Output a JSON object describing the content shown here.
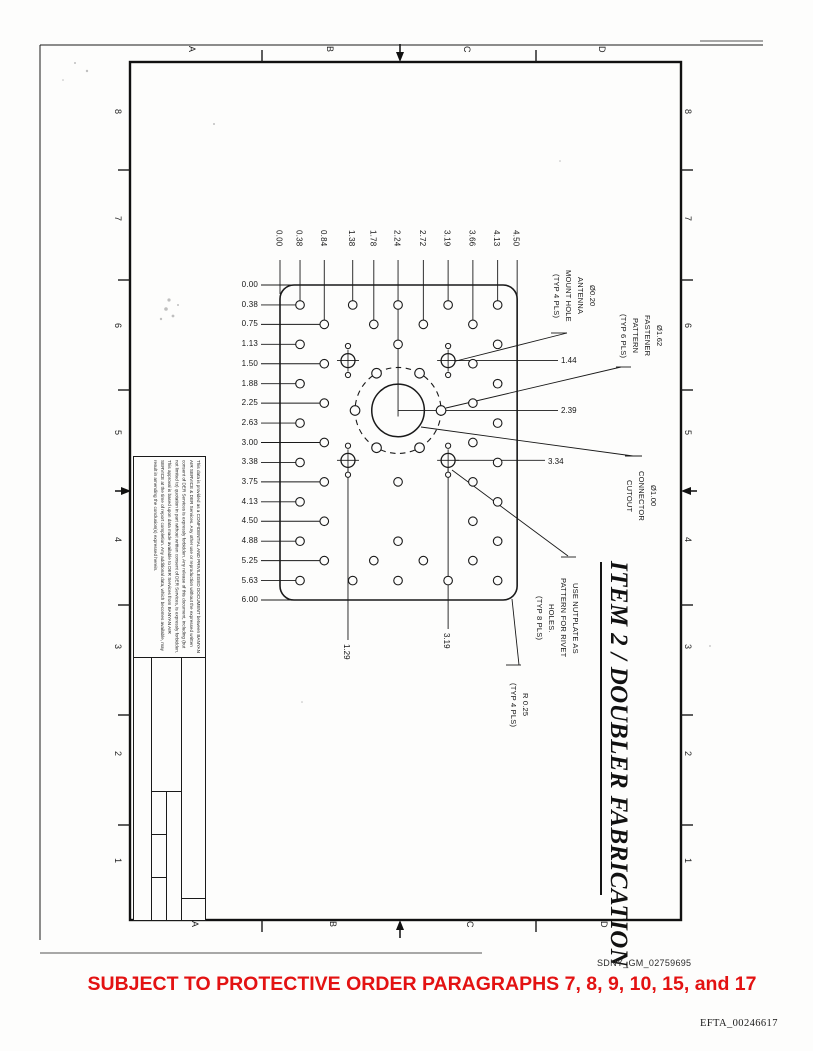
{
  "page": {
    "protective_order_text": "SUBJECT TO PROTECTIVE ORDER PARAGRAPHS 7, 8, 9, 10, 15, and 17",
    "bates_top": "SDNY_GM_02759695",
    "bates_bottom": "EFTA_00246617",
    "red_color": "#e31212"
  },
  "zones": {
    "letters": [
      "A",
      "B",
      "C",
      "D"
    ],
    "numbers": [
      "8",
      "7",
      "6",
      "5",
      "4",
      "3",
      "2",
      "1"
    ]
  },
  "drawing": {
    "item_title": "ITEM 2 / DOUBLER FABRICATION",
    "col_ordinates": [
      "0.00",
      "0.38",
      "0.84",
      "1.38",
      "1.78",
      "2.24",
      "2.72",
      "3.19",
      "3.66",
      "4.13",
      "4.50"
    ],
    "row_ordinates": [
      "0.00",
      "0.38",
      "0.75",
      "1.13",
      "1.50",
      "1.88",
      "2.25",
      "2.63",
      "3.00",
      "3.38",
      "3.75",
      "4.13",
      "4.50",
      "4.88",
      "5.25",
      "5.63",
      "6.00"
    ],
    "rivet_rows": [
      {
        "y": 0.38,
        "cols": [
          0.38,
          1.38,
          2.24,
          3.19,
          4.13
        ]
      },
      {
        "y": 0.75,
        "cols": [
          0.84,
          1.78,
          2.72,
          3.66
        ]
      },
      {
        "y": 1.13,
        "cols": [
          0.38,
          2.24,
          4.13
        ]
      },
      {
        "y": 1.5,
        "cols": [
          0.84,
          3.66
        ]
      },
      {
        "y": 1.88,
        "cols": [
          0.38,
          4.13
        ]
      },
      {
        "y": 2.25,
        "cols": [
          0.84,
          3.66
        ]
      },
      {
        "y": 2.63,
        "cols": [
          0.38,
          4.13
        ]
      },
      {
        "y": 3.0,
        "cols": [
          0.84,
          3.66
        ]
      },
      {
        "y": 3.38,
        "cols": [
          0.38,
          4.13
        ]
      },
      {
        "y": 3.75,
        "cols": [
          0.84,
          2.24,
          3.66
        ]
      },
      {
        "y": 4.13,
        "cols": [
          0.38,
          4.13
        ]
      },
      {
        "y": 4.5,
        "cols": [
          0.84,
          3.66
        ]
      },
      {
        "y": 4.88,
        "cols": [
          0.38,
          2.24,
          4.13
        ]
      },
      {
        "y": 5.25,
        "cols": [
          0.84,
          1.78,
          2.72,
          3.66
        ]
      },
      {
        "y": 5.63,
        "cols": [
          0.38,
          1.38,
          2.24,
          3.19,
          4.13
        ]
      }
    ],
    "cutout": {
      "x": 2.24,
      "y": 2.39
    },
    "bolt_circle": {
      "hole_count": 6
    },
    "antenna": {
      "xs": [
        1.29,
        3.19
      ],
      "ys": [
        1.44,
        3.34
      ]
    },
    "dims_right": [
      "1.44",
      "2.39",
      "3.34"
    ],
    "dims_bottom": [
      "1.29",
      "3.19"
    ],
    "callouts": {
      "antenna": [
        "Ø0.20",
        "ANTENNA",
        "MOUNT HOLE",
        "(TYP 4 PLS)"
      ],
      "fastener": [
        "Ø1.62",
        "FASTENER",
        "PATTERN",
        "(TYP 6 PLS)"
      ],
      "connector": [
        "Ø1.00",
        "CONNECTOR",
        "CUTOUT"
      ],
      "nutplate": [
        "USE NUTPLATE AS",
        "PATTERN FOR RIVET",
        "HOLES.",
        "(TYP 8 PLS)"
      ],
      "corner_radius": [
        "R 0.25",
        "(TYP 4 PLS)"
      ]
    }
  },
  "title_block": {
    "confidentiality": "This data is provided as a CONFIDENTIAL AND PRIVILEGED DOCUMENT between BANYAN AIR SERVICE & DER Services. Any other use or reproduction without the expressed written consent of DER Services is expressly forbidden. Any release of this document, including (but not limited to) quotation in part without written consent of DER Services, is expressly forbidden. This approval is based upon data made available to DER Services from BANYAN AIR SERVICE at the time of report completion. Any additional data, which becomes available, may result in amending the conclusion(s) expressed herein.",
    "serial_label": "SERIAL No.",
    "serial_value": "20115",
    "company": "DER SERVICES",
    "address_lines": [
      "2300 N.W. 62nd STREET, Suite C-106,",
      "FT. LAUDERDALE, FL 33309",
      "(954) 971-0853, FAX (954) 971-0856"
    ],
    "dwg_no_label": "DWG NO",
    "dwg_no": "2006-173-1",
    "rev_label": "REV",
    "rev_value": "I/R",
    "size_label": "SIZE",
    "size_value": "B",
    "drawn_by_label": "DRAWN BY:",
    "drawn_by_value": "W.D.OLIVERI",
    "scale_label": "SCALE",
    "scale_value": "0.5 = 1",
    "sheet_label": "SHEET",
    "sheet_value": "3 OF 3"
  }
}
